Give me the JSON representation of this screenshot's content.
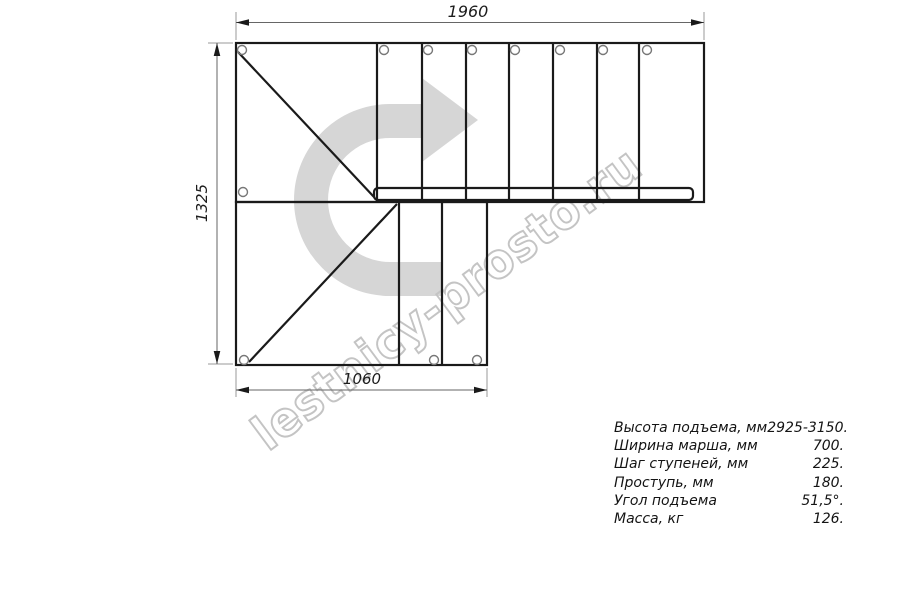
{
  "drawing": {
    "title_hint": "staircase-plan-view",
    "dimensions": {
      "top_width_mm": "1960",
      "left_height_mm": "1325",
      "bottom_width_mm": "1060"
    },
    "watermark": "lestnicy-prosto.ru",
    "colors": {
      "structure_line": "#1a1a1a",
      "dimension_line": "#666666",
      "extension_line": "#9a9a9a",
      "hole_circle": "#777777",
      "turn_arrow_fill": "#d6d6d6",
      "watermark_stroke": "#c4c4c4"
    }
  },
  "specs": {
    "rows": [
      {
        "label": "Высота подъема, мм",
        "value": "2925-3150."
      },
      {
        "label": "Ширина марша, мм",
        "value": "700."
      },
      {
        "label": "Шаг ступеней, мм",
        "value": "225."
      },
      {
        "label": "Проступь, мм",
        "value": "180."
      },
      {
        "label": "Угол подъема",
        "value": "51,5°."
      },
      {
        "label": "Масса, кг",
        "value": "126."
      }
    ]
  }
}
